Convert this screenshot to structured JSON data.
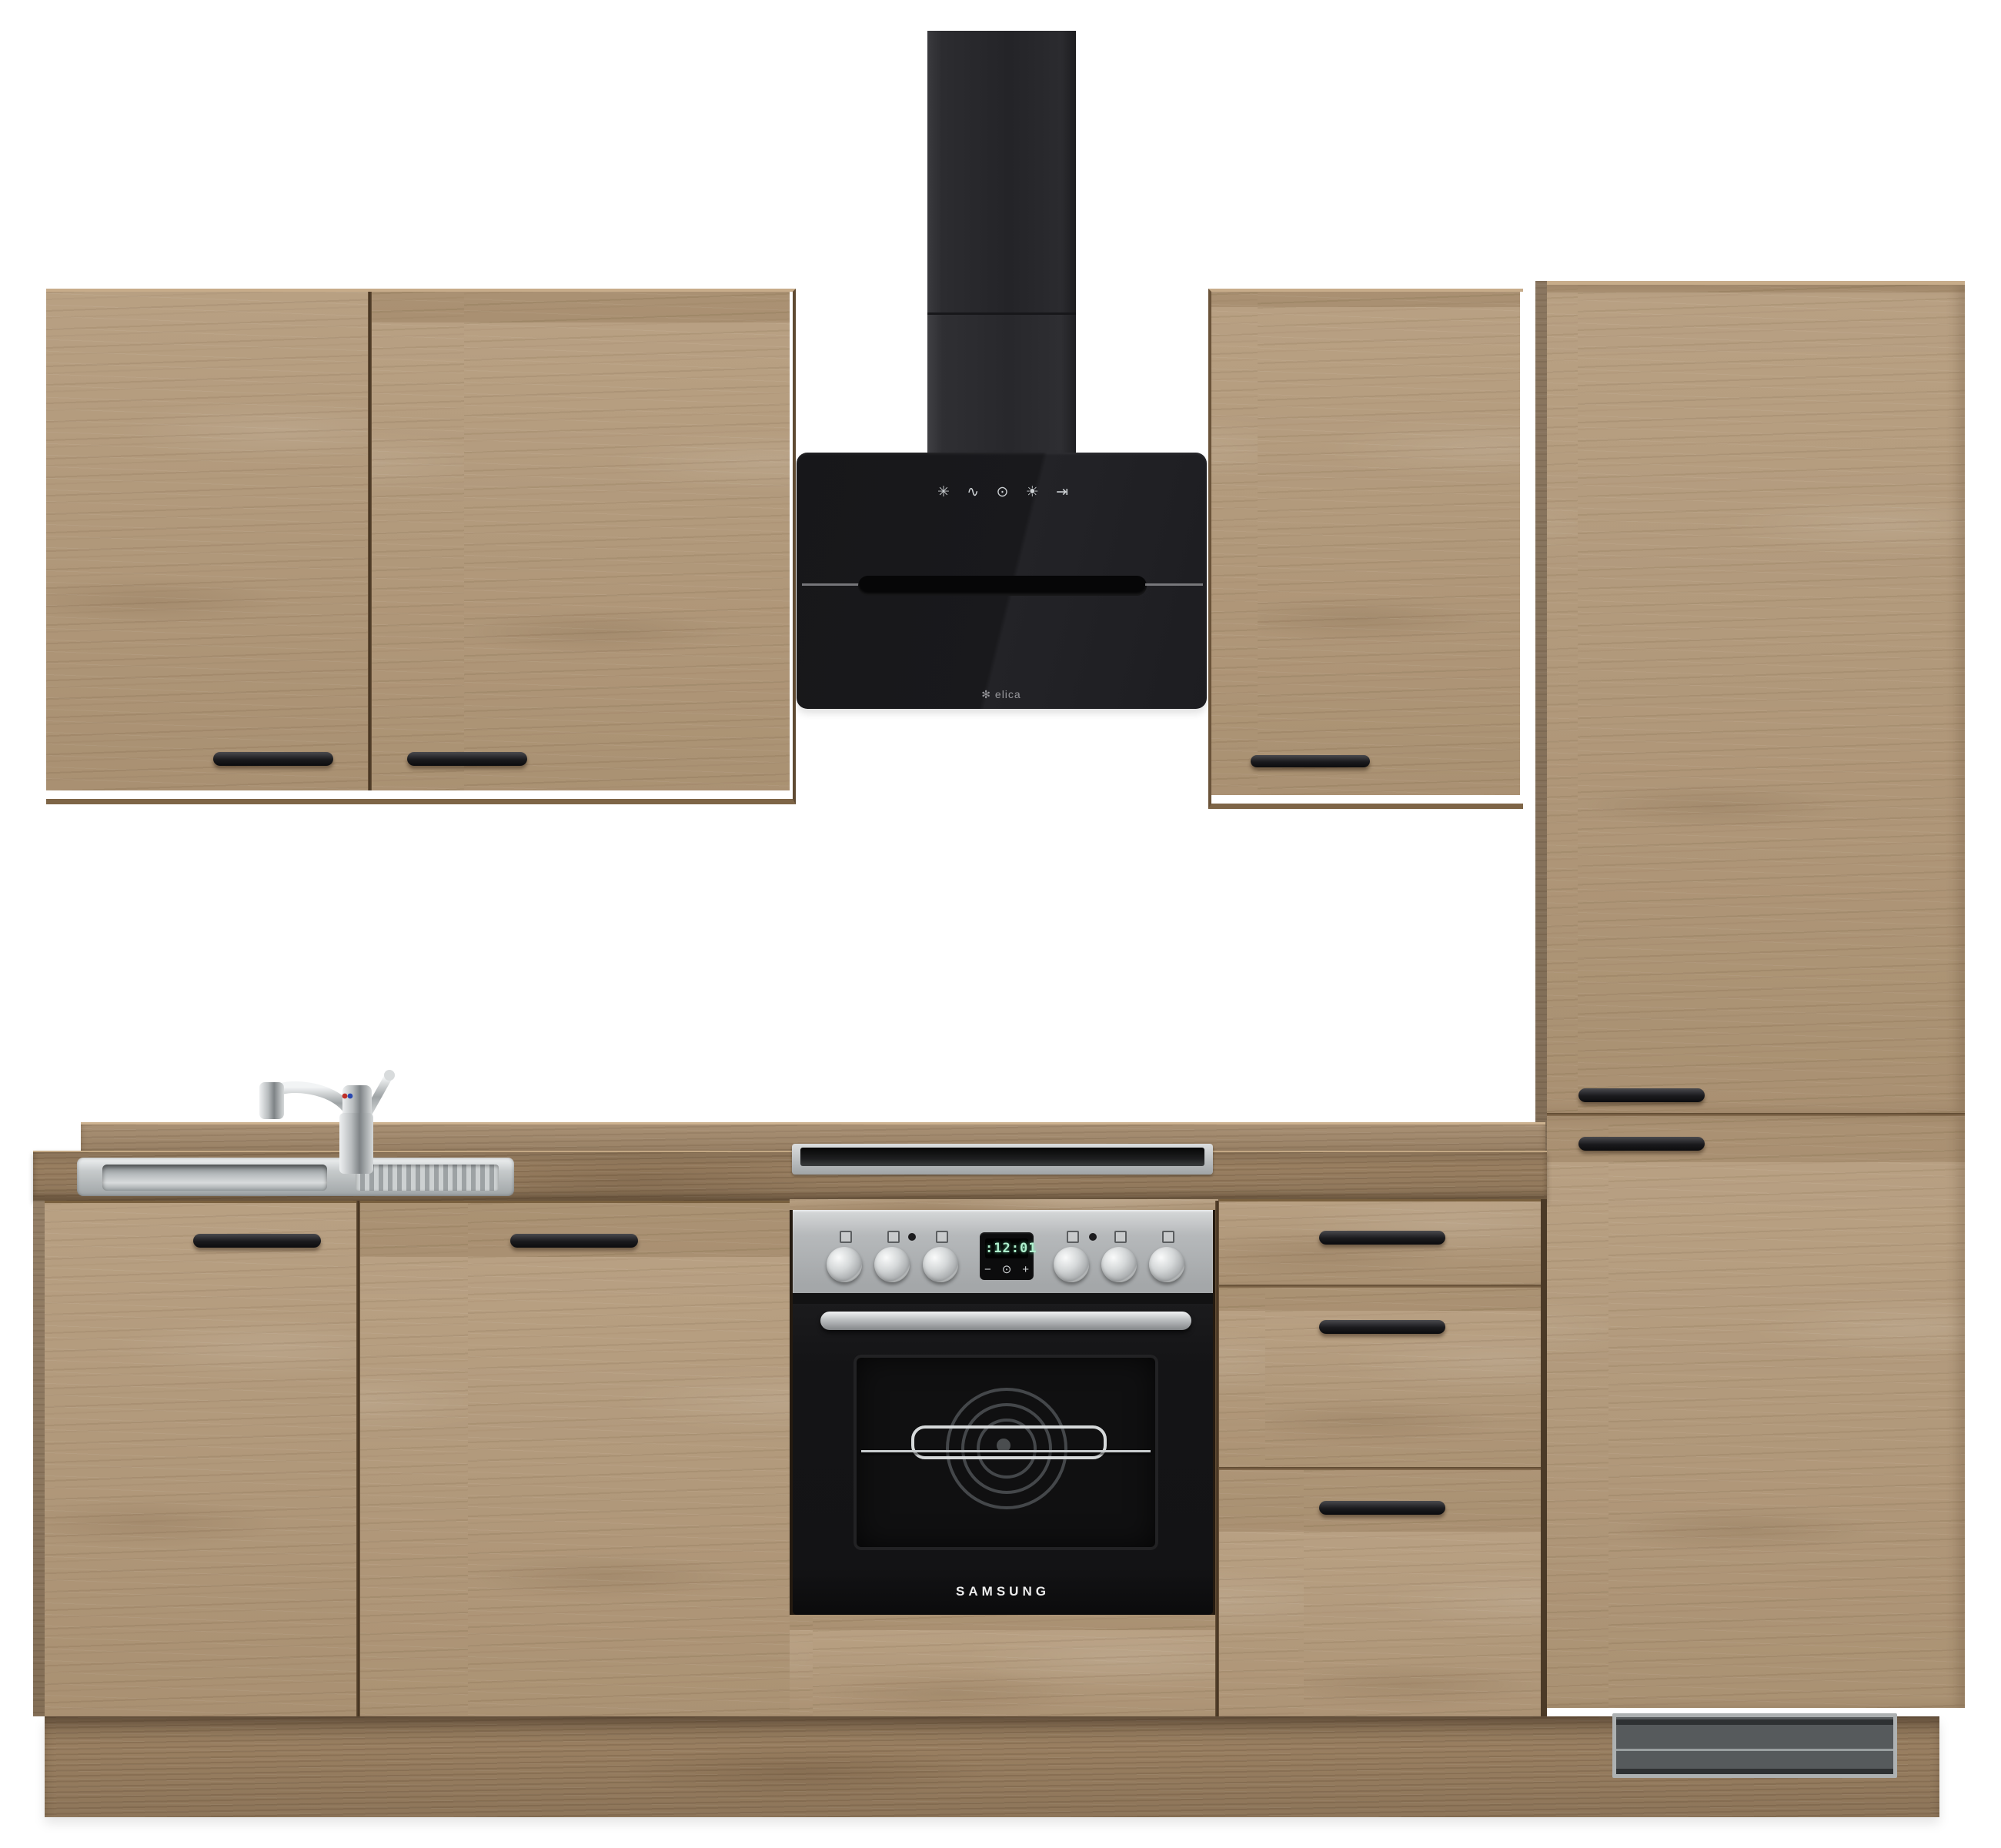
{
  "scene": {
    "description": "Oak-finish kitchen unit product photo on white background",
    "background": "#ffffff"
  },
  "palette": {
    "wood_light": "#b29878",
    "wood_mid": "#a2886a",
    "wood_dark": "#997f61",
    "handle_black": "#1a1a1d",
    "hood_glass": "#1a1a1d",
    "chimney_gray": "#2a2a2d",
    "steel": "#bcbfc1",
    "oven_black": "#151517",
    "display_green": "#aef0cd",
    "grille_gray": "#55595b"
  },
  "hood": {
    "brand_logo": "✻",
    "brand": "elica",
    "touch_icons": [
      {
        "name": "fan-speed-icon",
        "glyph": "✳"
      },
      {
        "name": "boost-icon",
        "glyph": "∿"
      },
      {
        "name": "power-icon",
        "glyph": "⊙"
      },
      {
        "name": "light-icon",
        "glyph": "☀"
      },
      {
        "name": "timer-icon",
        "glyph": "⇥"
      }
    ]
  },
  "oven": {
    "brand": "SAMSUNG",
    "display": {
      "indicator": ":",
      "time": "12:01",
      "minus": "−",
      "power": "⊙",
      "plus": "+"
    },
    "knob_count": 6
  }
}
